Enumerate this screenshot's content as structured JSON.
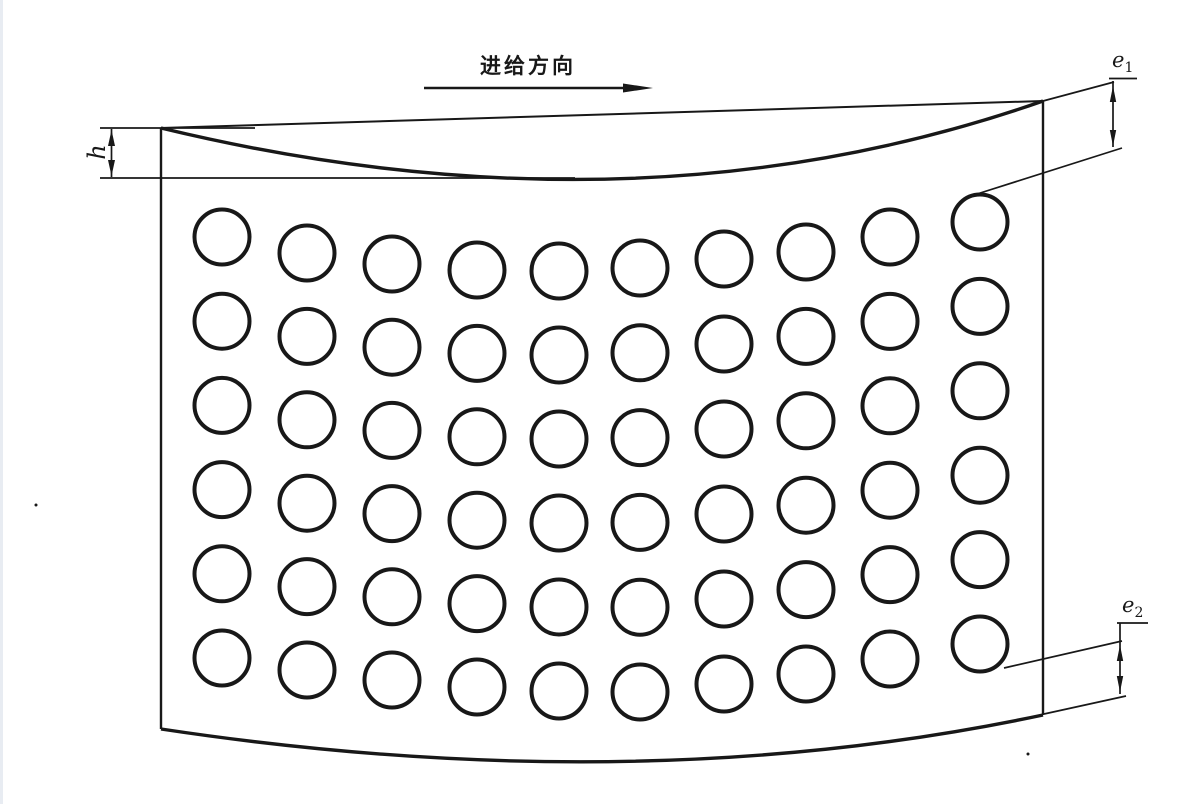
{
  "drawing": {
    "feed_direction_label": "进给方向",
    "dimensions": {
      "h": {
        "label": "h"
      },
      "e1": {
        "base": "e",
        "sub": "1"
      },
      "e2": {
        "base": "e",
        "sub": "2"
      }
    },
    "hole_grid": {
      "rows": 6,
      "columns": 10,
      "hole_radius_px": 27.5,
      "column_x": [
        222,
        307,
        392,
        477,
        559,
        640,
        724,
        806,
        890,
        980
      ],
      "first_row_y": [
        237,
        253,
        264,
        270,
        271,
        268,
        259,
        252,
        237,
        222
      ],
      "last_row_y": [
        658,
        670,
        680,
        687,
        691,
        692,
        684,
        674,
        659,
        644
      ]
    },
    "colors": {
      "ink": "#181818",
      "paper": "#ffffff",
      "page_edge": "#e8ecf2"
    }
  }
}
